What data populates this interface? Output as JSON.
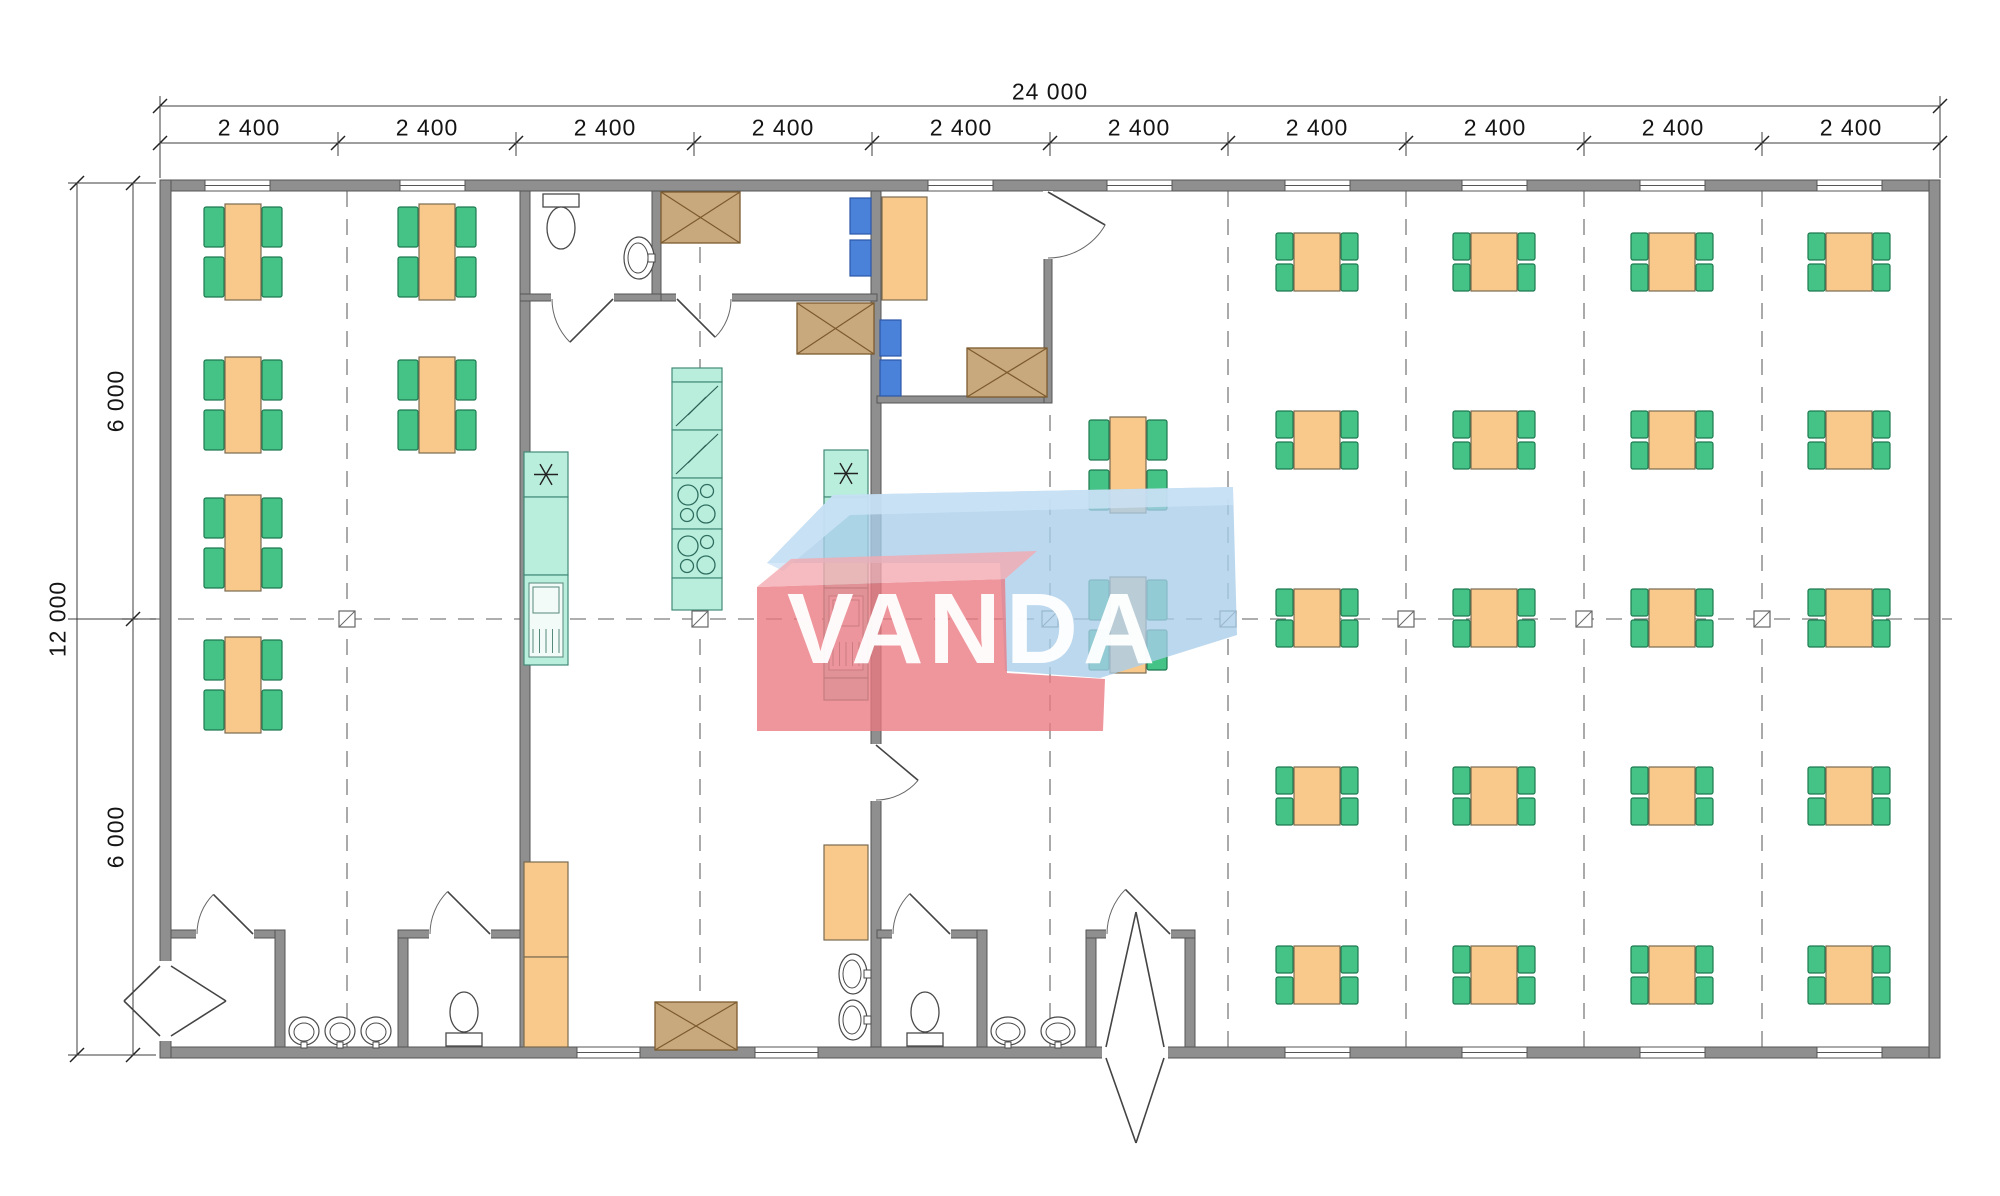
{
  "watermark": {
    "text": "VANDA"
  },
  "dimensions": {
    "top": {
      "total_label": "24 000",
      "bay_labels": [
        "2 400",
        "2 400",
        "2 400",
        "2 400",
        "2 400",
        "2 400",
        "2 400",
        "2 400",
        "2 400",
        "2 400"
      ],
      "line1_y": 106,
      "line2_y": 143,
      "ticks": [
        160,
        338,
        516,
        694,
        872,
        1050,
        1228,
        1406,
        1584,
        1762,
        1940
      ],
      "bay_centers": [
        249,
        427,
        605,
        783,
        961,
        1139,
        1317,
        1495,
        1673,
        1851
      ],
      "total_label_pos": [
        1050,
        92
      ]
    },
    "left": {
      "total_label": "12 000",
      "seg_labels": [
        "6 000",
        "6 000"
      ],
      "line1_x": 77,
      "line2_x": 133,
      "ticks": [
        183,
        619,
        1055
      ],
      "seg_centers": [
        401,
        837
      ],
      "total_label_pos": [
        58,
        619
      ]
    }
  },
  "colors": {
    "wall": "#8f8f8f",
    "wallEdge": "#565656",
    "dim": "#3c3c3c",
    "grid": "#7d7d7d",
    "table": "#f9c98c",
    "tableEdge": "#7a6a50",
    "chair": "#45c285",
    "chairEdge": "#1d7a50",
    "blueChair": "#4b82d9",
    "blueChairEdge": "#2b57a8",
    "teal": "#b9eedd",
    "tealEdge": "#418a77",
    "tealInner": "#f2fbf8",
    "tan": "#c8a97e",
    "tanEdge": "#7c5a2e",
    "sanitary": "#ffffff",
    "sanitaryEdge": "#4a4a4a"
  },
  "plan": {
    "walls": [
      [
        160,
        180,
        1780,
        11
      ],
      [
        160,
        1047,
        1780,
        11
      ],
      [
        160,
        180,
        11,
        878
      ],
      [
        1929,
        180,
        11,
        878
      ],
      [
        520,
        191,
        10,
        856
      ],
      [
        871,
        191,
        10,
        856
      ],
      [
        652,
        191,
        9,
        110
      ],
      [
        520,
        294,
        141,
        7
      ],
      [
        661,
        294,
        216,
        7
      ],
      [
        877,
        396,
        175,
        7
      ],
      [
        1044,
        191,
        8,
        212
      ],
      [
        171,
        930,
        112,
        8
      ],
      [
        275,
        930,
        10,
        117
      ],
      [
        398,
        930,
        10,
        117
      ],
      [
        398,
        930,
        122,
        8
      ],
      [
        877,
        930,
        108,
        8
      ],
      [
        977,
        930,
        10,
        117
      ],
      [
        1086,
        930,
        10,
        117
      ],
      [
        1185,
        930,
        10,
        117
      ],
      [
        1086,
        930,
        109,
        8
      ]
    ],
    "windows": {
      "top": [
        [
          205,
          270
        ],
        [
          400,
          465
        ],
        [
          928,
          993
        ],
        [
          1107,
          1172
        ],
        [
          1285,
          1350
        ],
        [
          1462,
          1527
        ],
        [
          1640,
          1705
        ],
        [
          1817,
          1882
        ]
      ],
      "bottom": [
        [
          577,
          640
        ],
        [
          755,
          818
        ],
        [
          1285,
          1350
        ],
        [
          1462,
          1527
        ],
        [
          1640,
          1705
        ],
        [
          1817,
          1882
        ]
      ]
    },
    "door_openings": [
      [
        871,
        745,
        10,
        55
      ],
      [
        552,
        294,
        61,
        7
      ],
      [
        677,
        294,
        54,
        7
      ],
      [
        1044,
        192,
        8,
        66
      ],
      [
        197,
        930,
        56,
        8
      ],
      [
        430,
        930,
        60,
        8
      ],
      [
        893,
        930,
        57,
        8
      ],
      [
        1107,
        930,
        63,
        8
      ],
      [
        160,
        962,
        11,
        78
      ],
      [
        1103,
        1047,
        64,
        11
      ]
    ],
    "swing_doors": [
      {
        "hinge": [
          613,
          299
        ],
        "start": [
          552,
          299
        ],
        "angle": -45
      },
      {
        "hinge": [
          677,
          299
        ],
        "start": [
          731,
          299
        ],
        "angle": 45
      },
      {
        "hinge": [
          1048,
          192
        ],
        "start": [
          1048,
          258
        ],
        "angle": -60
      },
      {
        "hinge": [
          876,
          745
        ],
        "start": [
          876,
          800
        ],
        "angle": -50
      },
      {
        "hinge": [
          253,
          934
        ],
        "start": [
          197,
          934
        ],
        "angle": 45
      },
      {
        "hinge": [
          490,
          934
        ],
        "start": [
          430,
          934
        ],
        "angle": 45
      },
      {
        "hinge": [
          950,
          934
        ],
        "start": [
          893,
          934
        ],
        "angle": 45
      },
      {
        "hinge": [
          1170,
          934
        ],
        "start": [
          1107,
          934
        ],
        "angle": 45
      }
    ],
    "chevron_doors": [
      [
        [
          171,
          966
        ],
        [
          226,
          1001
        ]
      ],
      [
        [
          171,
          1036
        ],
        [
          226,
          1001
        ]
      ],
      [
        [
          160,
          966
        ],
        [
          124,
          1001
        ]
      ],
      [
        [
          160,
          1036
        ],
        [
          124,
          1001
        ]
      ],
      [
        [
          1106,
          1047
        ],
        [
          1136,
          912
        ]
      ],
      [
        [
          1164,
          1047
        ],
        [
          1136,
          912
        ]
      ],
      [
        [
          1106,
          1058
        ],
        [
          1136,
          1143
        ]
      ],
      [
        [
          1164,
          1058
        ],
        [
          1136,
          1143
        ]
      ]
    ],
    "grid": {
      "v": [
        347,
        700,
        1050,
        1228,
        1406,
        1584,
        1762
      ],
      "v_y": [
        191,
        1047
      ],
      "h_y": 619,
      "h_x": [
        122,
        1952
      ],
      "markers": [
        347,
        700,
        1050,
        1228,
        1406,
        1584,
        1762
      ]
    },
    "tables_tall": [
      [
        243,
        252
      ],
      [
        243,
        405
      ],
      [
        243,
        543
      ],
      [
        243,
        685
      ],
      [
        437,
        252
      ],
      [
        437,
        405
      ],
      [
        1128,
        465
      ],
      [
        1128,
        625
      ]
    ],
    "tables_small": {
      "cols": [
        1317,
        1494,
        1672,
        1849
      ],
      "rows": [
        262,
        440,
        618,
        796,
        975
      ]
    },
    "kitchen_strips": [
      {
        "x": 524,
        "y": 452,
        "w": 44,
        "sections": [
          {
            "t": "star",
            "h": 45
          },
          {
            "t": "plain",
            "h": 78
          },
          {
            "t": "sink",
            "h": 90
          }
        ]
      },
      {
        "x": 824,
        "y": 450,
        "w": 44,
        "sections": [
          {
            "t": "star",
            "h": 47
          },
          {
            "t": "plain",
            "h": 91
          },
          {
            "t": "sink",
            "h": 90
          },
          {
            "t": "plain",
            "h": 22
          }
        ]
      },
      {
        "x": 672,
        "y": 368,
        "w": 50,
        "sections": [
          {
            "t": "plain",
            "h": 14
          },
          {
            "t": "fridge",
            "h": 48
          },
          {
            "t": "fridge",
            "h": 48
          },
          {
            "t": "stove",
            "h": 51
          },
          {
            "t": "stove",
            "h": 49
          },
          {
            "t": "plain",
            "h": 32
          }
        ]
      }
    ],
    "cabinets": [
      [
        524,
        862,
        44,
        95
      ],
      [
        524,
        957,
        44,
        90
      ],
      [
        824,
        845,
        44,
        95
      ]
    ],
    "office_desk": [
      882,
      197,
      45,
      103
    ],
    "wardrobes": [
      [
        661,
        192,
        79,
        51
      ],
      [
        797,
        303,
        77,
        51
      ],
      [
        967,
        348,
        80,
        49
      ],
      [
        655,
        1002,
        82,
        48
      ]
    ],
    "blue_chairs": [
      [
        850,
        198,
        21,
        36
      ],
      [
        850,
        240,
        21,
        36
      ],
      [
        880,
        320,
        21,
        36
      ],
      [
        880,
        360,
        21,
        36
      ]
    ],
    "toilets": [
      {
        "dir": "down",
        "x": 561,
        "y": 193
      },
      {
        "dir": "up",
        "x": 464,
        "y": 1047
      },
      {
        "dir": "up",
        "x": 925,
        "y": 1047
      }
    ],
    "basins_bottom": [
      {
        "x": 304,
        "r": 15
      },
      {
        "x": 340,
        "r": 15
      },
      {
        "x": 376,
        "r": 15
      },
      {
        "x": 1008,
        "r": 17
      },
      {
        "x": 1058,
        "r": 17
      }
    ],
    "basins_wall": [
      {
        "x": 853,
        "y": 974
      },
      {
        "x": 853,
        "y": 1020
      }
    ],
    "sink_wc": {
      "x": 639,
      "y": 258
    }
  }
}
